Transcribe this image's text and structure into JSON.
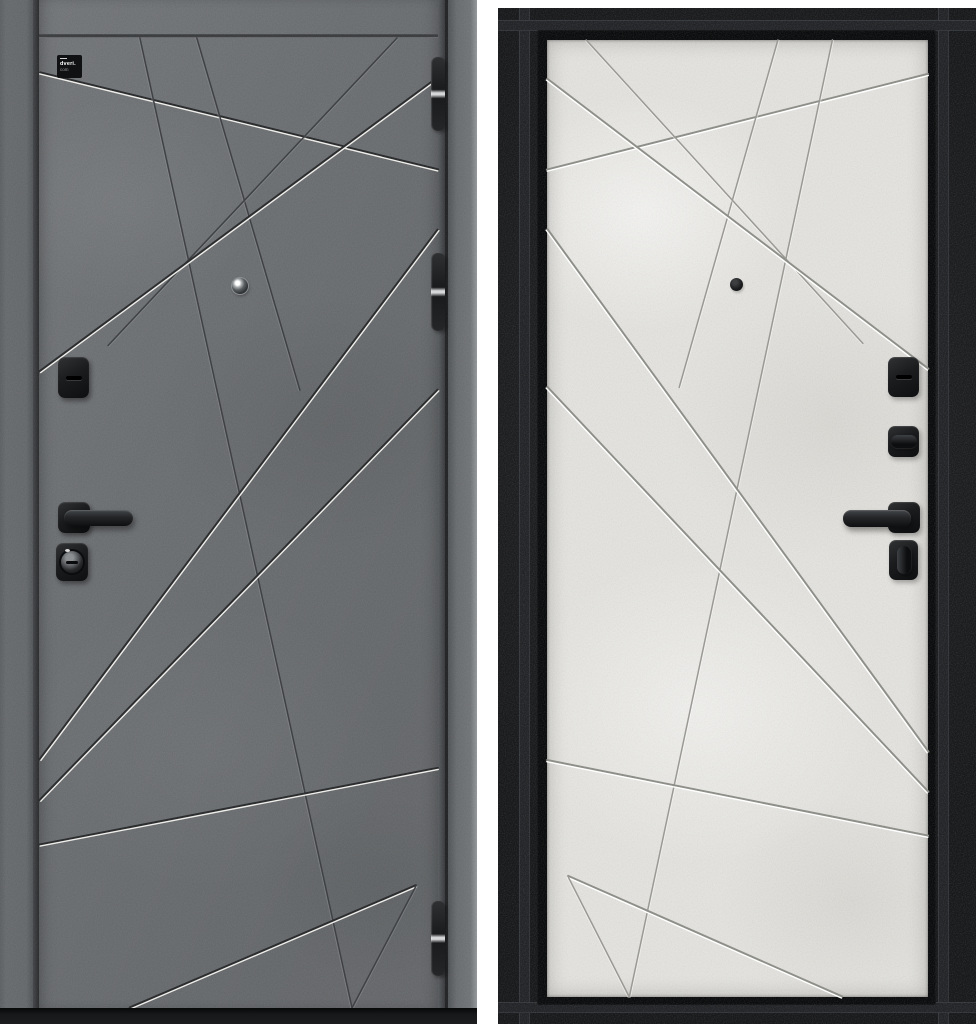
{
  "meta": {
    "subject": "steel entry door product photo",
    "views": {
      "front": "exterior side, dark concrete finish",
      "back": "interior side, light concrete panel in black frame"
    }
  },
  "brand": {
    "logo_line1": "dveri.",
    "logo_line2": "com"
  },
  "colors": {
    "front_leaf": "#6e7174",
    "front_frame": "#686b6e",
    "front_groove_highlight": "#eeede9",
    "front_groove_shadow": "#2b2d2f",
    "front_groove_dark": "#3f4144",
    "back_frame": "#1b1c1e",
    "back_panel": "#e2e1dd",
    "back_groove_line": "#8f8f8a",
    "back_groove_highlight": "#ffffff",
    "hardware_black": "#1b1c1e",
    "bottom_band": "#17181a",
    "background": "#ffffff"
  },
  "groove_lines": [
    [
      0.0,
      0.036,
      1.0,
      0.136,
      "silver"
    ],
    [
      0.251,
      0.0,
      0.784,
      1.0,
      "dark"
    ],
    [
      0.394,
      0.0,
      0.653,
      0.363,
      "dark"
    ],
    [
      0.897,
      0.0,
      0.171,
      0.317,
      "dark"
    ],
    [
      1.0,
      0.041,
      0.0,
      0.344,
      "silver"
    ],
    [
      1.0,
      0.198,
      0.0,
      0.744,
      "silver"
    ],
    [
      1.0,
      0.363,
      0.0,
      0.786,
      "silver"
    ],
    [
      0.0,
      0.832,
      1.0,
      0.753,
      "silver"
    ],
    [
      0.226,
      1.0,
      0.945,
      0.874,
      "silver"
    ],
    [
      0.945,
      0.874,
      0.784,
      1.002,
      "dark"
    ]
  ],
  "panels": {
    "front": {
      "x": 40,
      "y": 38,
      "w": 398,
      "h": 970,
      "mirror": false,
      "palette": {
        "shadow": "#2b2d2f",
        "light": "#eeede9",
        "darkline": "#3f4144",
        "faint": "#94979a"
      }
    },
    "back": {
      "x": 547,
      "y": 40,
      "w": 381,
      "h": 957,
      "mirror": true,
      "palette": {
        "shadow": "#8f8f8a",
        "light": "#ffffff",
        "darkline": "#9a9994",
        "faint": "#ffffff"
      }
    }
  },
  "hinges": [
    {
      "y": 57,
      "h": 74
    },
    {
      "y": 253,
      "h": 78
    },
    {
      "y": 901,
      "h": 75
    }
  ],
  "hardware": {
    "front": [
      "keyhole-escutcheon",
      "lever-handle",
      "cylinder-lock"
    ],
    "back": [
      "keyhole-escutcheon",
      "thumbturn",
      "lever-handle",
      "night-latch-knob"
    ]
  }
}
